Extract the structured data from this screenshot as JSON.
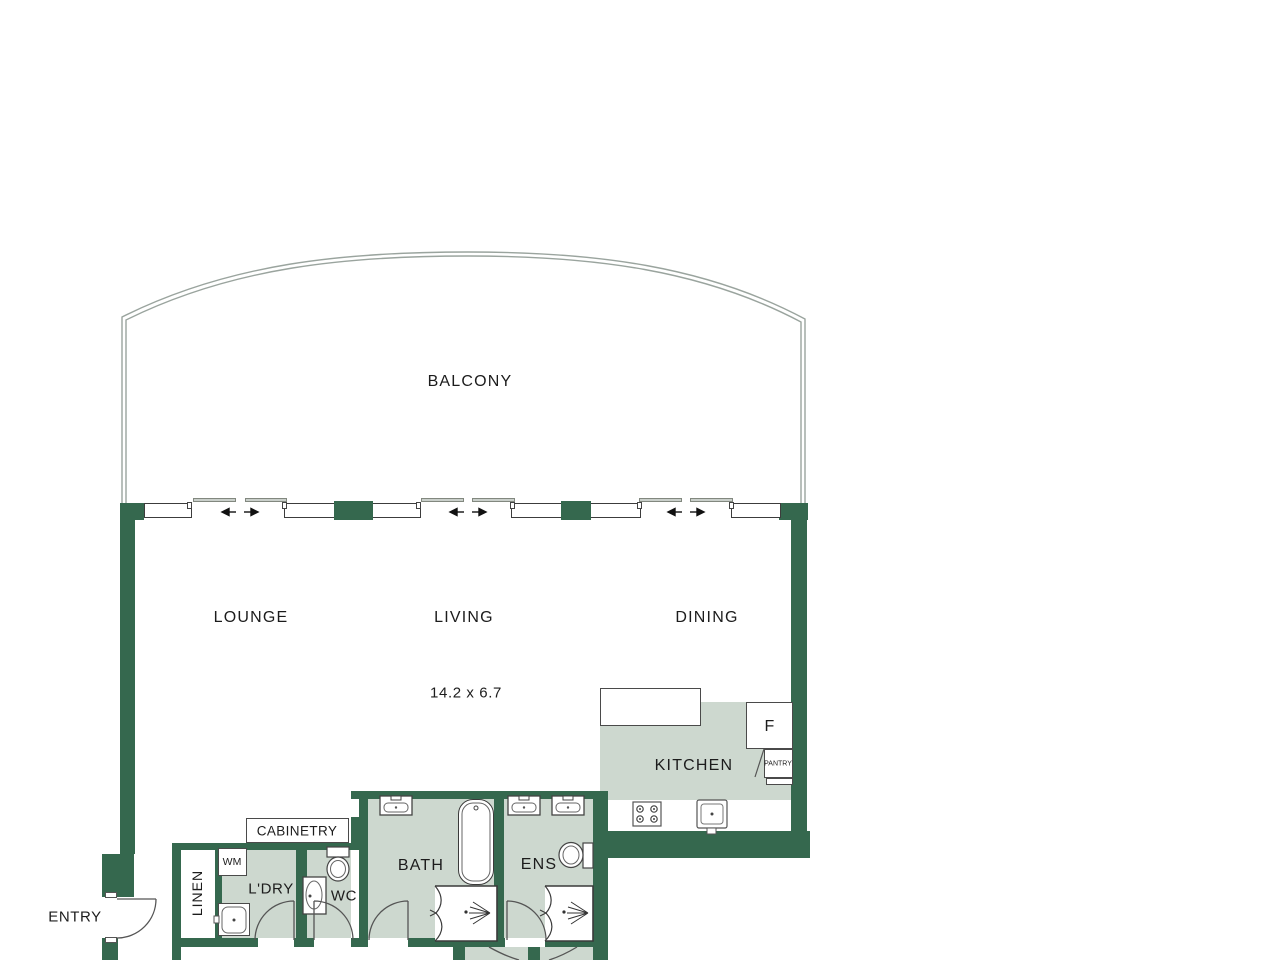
{
  "type": "apartment-floor-plan",
  "colors": {
    "wall_green": "#35684e",
    "floor_shade": "#cdd8cf",
    "balcony_outline": "#9aa49e",
    "text": "#1c1c1c"
  },
  "rooms": {
    "balcony": {
      "label": "BALCONY"
    },
    "lounge": {
      "label": "LOUNGE"
    },
    "living": {
      "label": "LIVING",
      "dimensions": "14.2 x 6.7"
    },
    "dining": {
      "label": "DINING"
    },
    "kitchen": {
      "label": "KITCHEN"
    },
    "bath": {
      "label": "BATH"
    },
    "ensuite": {
      "label": "ENS"
    },
    "wc": {
      "label": "WC"
    },
    "laundry": {
      "label": "L'DRY"
    },
    "linen": {
      "label": "LINEN"
    },
    "entry": {
      "label": "ENTRY"
    },
    "cabinetry": {
      "label": "CABINETRY"
    }
  },
  "fixtures": {
    "fridge_label": "F",
    "pantry_label": "PANTRY",
    "washing_machine_label": "WM"
  }
}
